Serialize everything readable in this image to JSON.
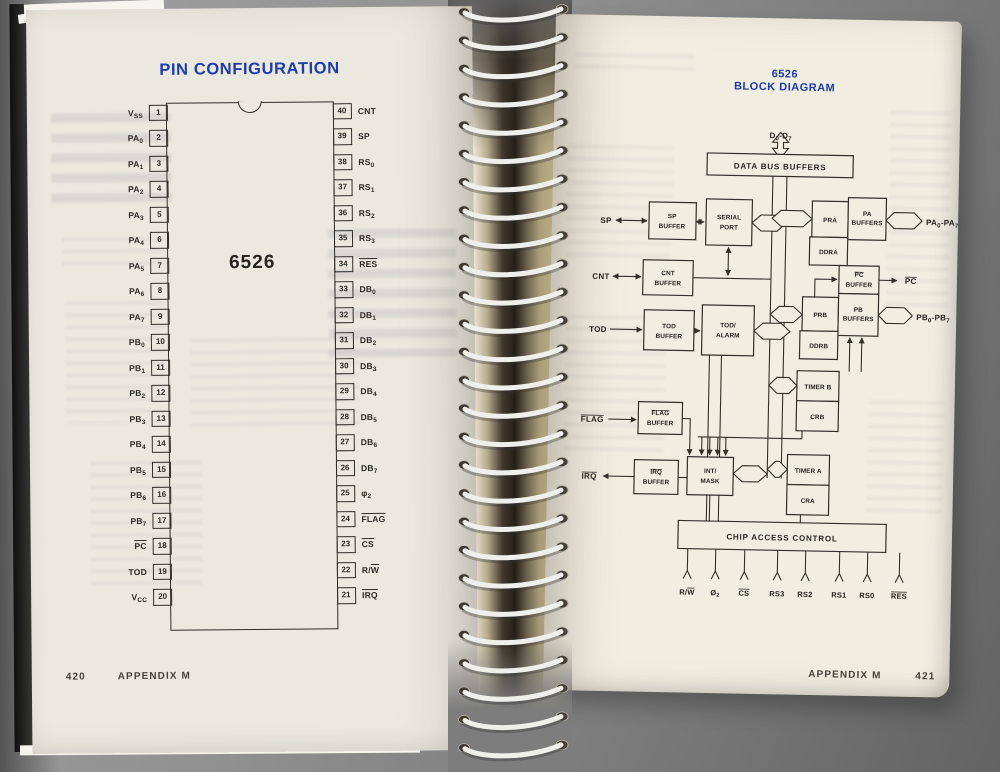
{
  "colors": {
    "accent_blue": "#1c3cb0",
    "page_left": "#ebe8e0",
    "page_right": "#f1ede1",
    "ink": "#2e2e2a",
    "backdrop_gray": "#8e8e8e"
  },
  "left_page": {
    "title": "PIN CONFIGURATION",
    "chip": {
      "name": "6526",
      "left_pins": [
        {
          "num": "1",
          "pre": "V",
          "sub": "SS"
        },
        {
          "num": "2",
          "pre": "PA",
          "sub": "0"
        },
        {
          "num": "3",
          "pre": "PA",
          "sub": "1"
        },
        {
          "num": "4",
          "pre": "PA",
          "sub": "2"
        },
        {
          "num": "5",
          "pre": "PA",
          "sub": "3"
        },
        {
          "num": "6",
          "pre": "PA",
          "sub": "4"
        },
        {
          "num": "7",
          "pre": "PA",
          "sub": "5"
        },
        {
          "num": "8",
          "pre": "PA",
          "sub": "6"
        },
        {
          "num": "9",
          "pre": "PA",
          "sub": "7"
        },
        {
          "num": "10",
          "pre": "PB",
          "sub": "0"
        },
        {
          "num": "11",
          "pre": "PB",
          "sub": "1"
        },
        {
          "num": "12",
          "pre": "PB",
          "sub": "2"
        },
        {
          "num": "13",
          "pre": "PB",
          "sub": "3"
        },
        {
          "num": "14",
          "pre": "PB",
          "sub": "4"
        },
        {
          "num": "15",
          "pre": "PB",
          "sub": "5"
        },
        {
          "num": "16",
          "pre": "PB",
          "sub": "6"
        },
        {
          "num": "17",
          "pre": "PB",
          "sub": "7"
        },
        {
          "num": "18",
          "bar": "PC"
        },
        {
          "num": "19",
          "pre": "TOD"
        },
        {
          "num": "20",
          "pre": "V",
          "sub": "CC"
        }
      ],
      "right_pins": [
        {
          "num": "40",
          "pre": "CNT"
        },
        {
          "num": "39",
          "pre": "SP"
        },
        {
          "num": "38",
          "pre": "RS",
          "sub": "0"
        },
        {
          "num": "37",
          "pre": "RS",
          "sub": "1"
        },
        {
          "num": "36",
          "pre": "RS",
          "sub": "2"
        },
        {
          "num": "35",
          "pre": "RS",
          "sub": "3"
        },
        {
          "num": "34",
          "bar": "RES"
        },
        {
          "num": "33",
          "pre": "DB",
          "sub": "0"
        },
        {
          "num": "32",
          "pre": "DB",
          "sub": "1"
        },
        {
          "num": "31",
          "pre": "DB",
          "sub": "2"
        },
        {
          "num": "30",
          "pre": "DB",
          "sub": "3"
        },
        {
          "num": "29",
          "pre": "DB",
          "sub": "4"
        },
        {
          "num": "28",
          "pre": "DB",
          "sub": "5"
        },
        {
          "num": "27",
          "pre": "DB",
          "sub": "6"
        },
        {
          "num": "26",
          "pre": "DB",
          "sub": "7"
        },
        {
          "num": "25",
          "pre": "φ",
          "sub": "2"
        },
        {
          "num": "24",
          "bar": "FLAG"
        },
        {
          "num": "23",
          "bar": "CS"
        },
        {
          "num": "22",
          "pre": "R/",
          "bar": "W"
        },
        {
          "num": "21",
          "bar": "IRQ"
        }
      ]
    },
    "footer": {
      "page_number": "420",
      "section": "APPENDIX M"
    }
  },
  "right_page": {
    "title": {
      "line1": "6526",
      "line2": "BLOCK DIAGRAM"
    },
    "diagram": {
      "d_range": {
        "pre": "D",
        "sub1": "0",
        "mid": "-D",
        "sub2": "7"
      },
      "boxes": {
        "data_bus_buffers": "DATA BUS BUFFERS",
        "sp_buffer": [
          "SP",
          "BUFFER"
        ],
        "serial_port": [
          "SERIAL",
          "PORT"
        ],
        "cnt_buffer": [
          "CNT",
          "BUFFER"
        ],
        "tod_buffer": [
          "TOD",
          "BUFFER"
        ],
        "tod_alarm": [
          "TOD/",
          "ALARM"
        ],
        "flag_buffer": [
          "FLAG",
          "BUFFER"
        ],
        "irq_buffer": [
          "IRQ",
          "BUFFER"
        ],
        "int_mask": [
          "INT/",
          "MASK"
        ],
        "pra": "PRA",
        "pa_buffers": [
          "PA",
          "BUFFERS"
        ],
        "ddra": "DDRA",
        "pc_buffer": [
          "PC",
          "BUFFER"
        ],
        "prb": "PRB",
        "pb_buffers": [
          "PB",
          "BUFFERS"
        ],
        "ddrb": "DDRB",
        "timer_b": "TIMER B",
        "crb": "CRB",
        "timer_a": "TIMER A",
        "cra": "CRA",
        "chip_access": "CHIP ACCESS CONTROL"
      },
      "external": {
        "sp": "SP",
        "cnt": "CNT",
        "tod": "TOD",
        "flag": "FLAG",
        "irq": "IRQ",
        "pc": "PC",
        "pa_range": {
          "pre": "PA",
          "sub1": "0",
          "mid": "-PA",
          "sub2": "7"
        },
        "pb_range": {
          "pre": "PB",
          "sub1": "0",
          "mid": "-PB",
          "sub2": "7"
        }
      },
      "chip_access_signals": [
        {
          "pre": "R/",
          "bar": "W"
        },
        {
          "pre": "Ø",
          "sub": "2"
        },
        {
          "bar": "CS"
        },
        {
          "pre": "RS3"
        },
        {
          "pre": "RS2"
        },
        {
          "pre": "RS1"
        },
        {
          "pre": "RS0"
        },
        {
          "bar": "RES"
        }
      ]
    },
    "footer": {
      "section": "APPENDIX M",
      "page_number": "421"
    }
  }
}
